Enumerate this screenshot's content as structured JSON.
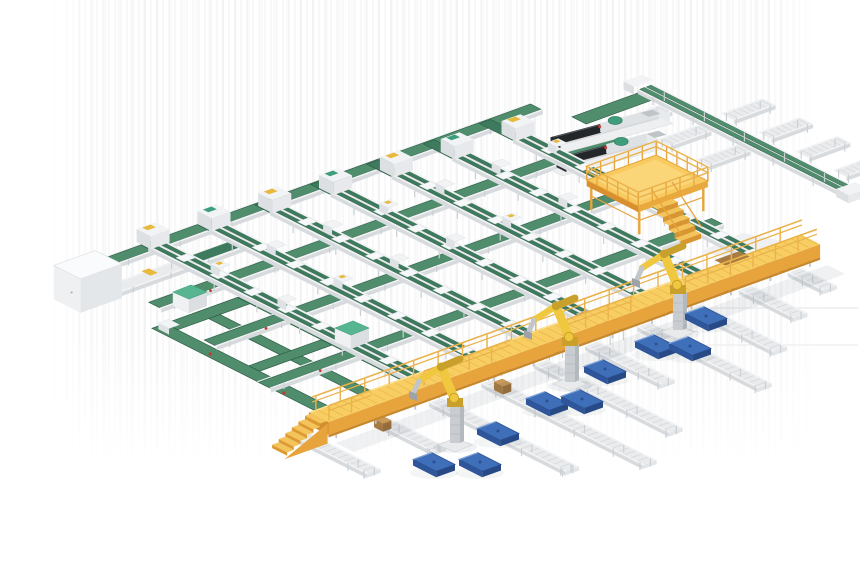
{
  "scene": {
    "title": "3D render of an automated conveyor sorting and robotic palletizing line",
    "components": {
      "sorting_lanes": {
        "label": "elevated dual-belt sorting lanes",
        "count": 7
      },
      "cross_conveyors": {
        "label": "long green transfer belt conveyors",
        "count": 4
      },
      "palletizing_robots": {
        "label": "yellow palletizing robot arms",
        "count": 3
      },
      "pallets": {
        "label": "blue pallets on floor",
        "count": 9
      },
      "walkway": {
        "label": "elevated yellow maintenance walkway with end stairs",
        "count": 1
      },
      "mezzanine": {
        "label": "yellow crossover mezzanine platform with stairs",
        "count": 1
      },
      "machines": {
        "label": "dark processing machines with green hoppers",
        "count": 2
      },
      "outfeed_spurs": {
        "label": "roller conveyor outfeed spurs",
        "count": 10
      },
      "branch_spur_tables": {
        "label": "branch roller spur tables (top right)",
        "count": 7
      },
      "floor_loop": {
        "label": "floor-level green conveyor loop",
        "count": 1
      },
      "control_cabinet": {
        "label": "white control cabinet",
        "count": 1
      },
      "mint_machines": {
        "label": "white machine units with mint-green tops",
        "count": 2
      },
      "cardboard_boxes": {
        "label": "tan cartons on spurs",
        "count": 2
      }
    }
  },
  "palette": {
    "background": "#ffffff",
    "frame_white": "#f2f3f5",
    "frame_light": "#e9ebed",
    "frame_shade": "#d8dbde",
    "frame_dark": "#c2c6ca",
    "green_main": "#4f8d6d",
    "green_dark": "#3e7a5e",
    "green_deep": "#2e5c45",
    "mint_green": "#58b592",
    "machine_green": "#3e9e7c",
    "deck_yellow": "#f8ce63",
    "deck_side_amber": "#e8a43c",
    "amber_deep": "#c8872b",
    "rail_amber": "#eab24a",
    "step_yellow": "#f4c45a",
    "robot_yellow": "#efc83f",
    "robot_shade": "#c9a02b",
    "pedestal_gray": "#c9cdd1",
    "pallet_blue": "#3e6fb8",
    "pallet_blue_dark": "#2b5092",
    "pallet_blue_light": "#7fa3d9",
    "machine_dark": "#34383c",
    "machine_black": "#24272a",
    "cardboard_tan": "#c89a5b",
    "cardboard_side": "#a87b42",
    "accent_yellow": "#e8b93c",
    "accent_red": "#c23b2e",
    "shadow": "rgba(70,80,90,0.08)"
  }
}
